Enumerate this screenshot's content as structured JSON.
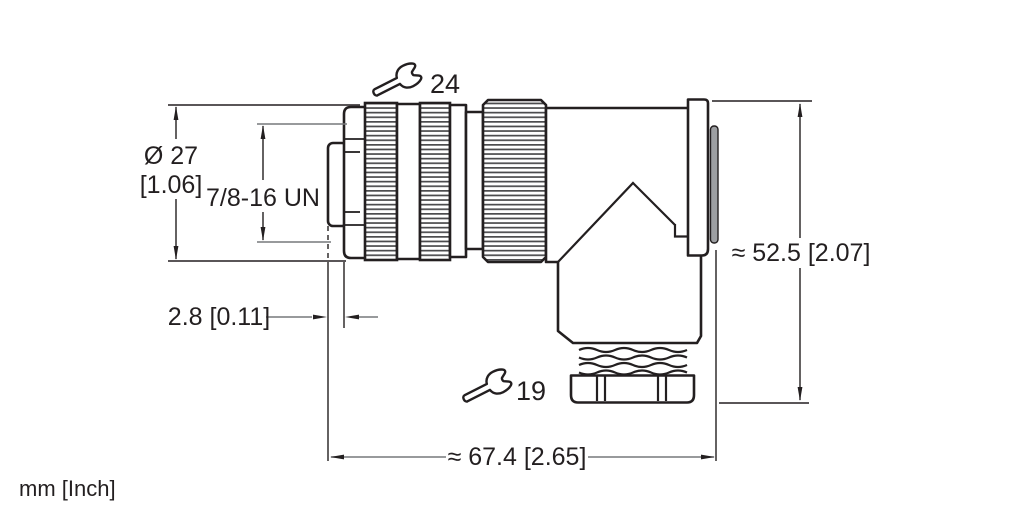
{
  "dimensions": {
    "diameter": {
      "mm": "Ø 27",
      "inch": "[1.06]"
    },
    "thread": {
      "label": "7/8-16 UN"
    },
    "offset": {
      "label": "2.8 [0.11]"
    },
    "length": {
      "label": "≈ 67.4 [2.65]"
    },
    "height": {
      "label": "≈ 52.5 [2.07]"
    }
  },
  "wrench_sizes": {
    "coupling_nut": "24",
    "cable_gland": "19"
  },
  "units": {
    "label": "mm [Inch]"
  },
  "colors": {
    "line": "#231f20",
    "dim_line": "#77787b",
    "seal": "#9d9fa2",
    "background": "#ffffff"
  }
}
